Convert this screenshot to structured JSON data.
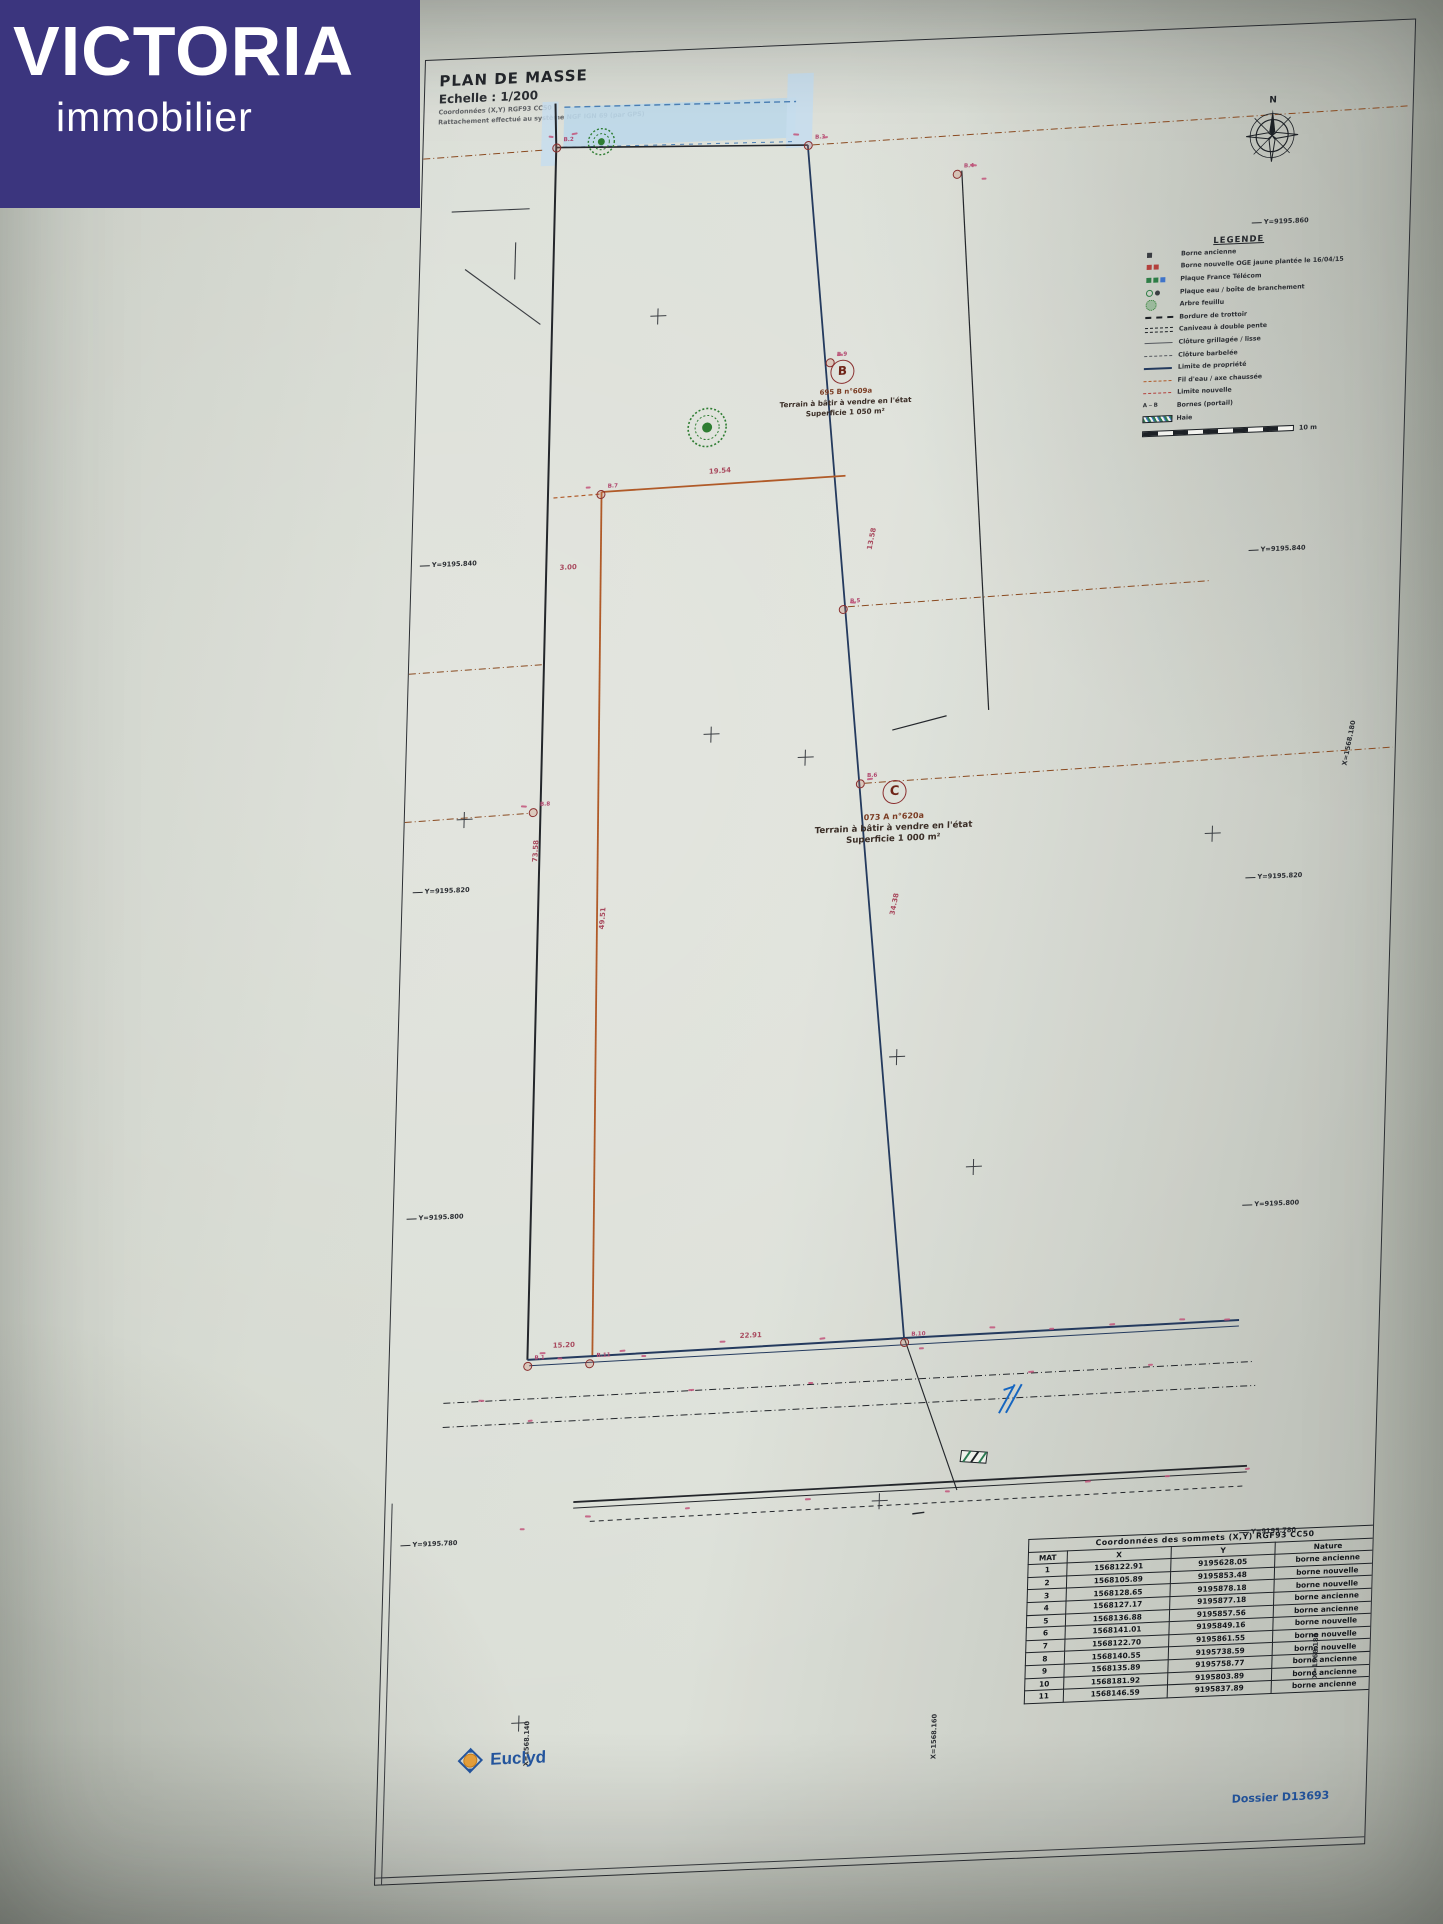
{
  "colors": {
    "brand_bg": "#3b357e",
    "blue_accent": "#2456a0",
    "boundary_navy": "#243a5e",
    "parcel_orange": "#b05a28",
    "annotation_pink": "#c2547a",
    "water_blue": "#bdd8e9"
  },
  "logo": {
    "brand": "VICTORIA",
    "subtitle": "immobilier"
  },
  "title_block": {
    "title": "PLAN DE MASSE",
    "scale": "Echelle : 1/200",
    "note1": "Coordonnées (X,Y) RGF93 CC50",
    "note2": "Rattachement effectué au système NGF IGN 69 (par GPS)"
  },
  "compass": {
    "label": "N"
  },
  "legend": {
    "title": "LEGENDE",
    "scale_label": "10 m",
    "items": [
      {
        "sym": "sqb",
        "label": "Borne ancienne"
      },
      {
        "sym": "sqr",
        "label": "Borne nouvelle OGE jaune plantée le 16/04/15"
      },
      {
        "sym": "sqg",
        "label": "Plaque France Télécom"
      },
      {
        "sym": "cg",
        "label": "Plaque eau / boîte de branchement"
      },
      {
        "sym": "tree",
        "label": "Arbre feuillu"
      },
      {
        "sym": "dashb",
        "label": "Bordure de trottoir"
      },
      {
        "sym": "dash2",
        "label": "Caniveau à double pente"
      },
      {
        "sym": "thin",
        "label": "Clôture grillagée / lisse"
      },
      {
        "sym": "thin2",
        "label": "Clôture barbelée"
      },
      {
        "sym": "blue",
        "label": "Limite de propriété"
      },
      {
        "sym": "orng",
        "label": "Fil d'eau / axe chaussée"
      },
      {
        "sym": "red",
        "label": "Limite nouvelle"
      },
      {
        "sym": "ab",
        "symtext": "A ⎯ B",
        "label": "Bornes (portail)"
      },
      {
        "sym": "hatch",
        "label": "Haie"
      }
    ]
  },
  "parcels": {
    "b": {
      "id": "B",
      "ref": "695 B n°609a",
      "desc": "Terrain à bâtir à vendre en l'état",
      "area": "Superficie 1 050 m²"
    },
    "c": {
      "id": "C",
      "ref": "073 A n°620a",
      "desc": "Terrain à bâtir à vendre en l'état",
      "area": "Superficie 1 000 m²"
    }
  },
  "grid": {
    "left": [
      {
        "text": "Y=9195.840",
        "x": 8,
        "y": 500
      },
      {
        "text": "Y=9195.820",
        "x": 10,
        "y": 826
      },
      {
        "text": "Y=9195.800",
        "x": 13,
        "y": 1152
      },
      {
        "text": "Y=9195.780",
        "x": 16,
        "y": 1478
      }
    ],
    "right": [
      {
        "text": "Y=9195.860",
        "x": 832,
        "y": 192
      },
      {
        "text": "Y=9195.840",
        "x": 838,
        "y": 519
      },
      {
        "text": "Y=9195.820",
        "x": 844,
        "y": 846
      },
      {
        "text": "Y=9195.800",
        "x": 850,
        "y": 1173
      },
      {
        "text": "Y=9195.780",
        "x": 856,
        "y": 1500
      }
    ],
    "bottom": [
      {
        "text": "X=1568.140",
        "x": 152,
        "y": 1700
      },
      {
        "text": "X=1568.160",
        "x": 560,
        "y": 1710
      },
      {
        "text": "X=1568.180",
        "x": 940,
        "y": 1645
      }
    ],
    "right_mid": {
      "text": "X=1568.180",
      "x": 944,
      "y": 735
    }
  },
  "dimensions": [
    {
      "text": "19.54",
      "x": 295,
      "y": 418,
      "r": -2
    },
    {
      "text": "3.00",
      "x": 148,
      "y": 508,
      "r": 0
    },
    {
      "text": "49.51",
      "x": 190,
      "y": 860,
      "r": -87
    },
    {
      "text": "73.58",
      "x": 121,
      "y": 790,
      "r": -88
    },
    {
      "text": "13.58",
      "x": 449,
      "y": 492,
      "r": -80
    },
    {
      "text": "34.38",
      "x": 482,
      "y": 858,
      "r": -80
    },
    {
      "text": "22.91",
      "x": 350,
      "y": 1283,
      "r": 0
    },
    {
      "text": "15.20",
      "x": 163,
      "y": 1285,
      "r": 0
    }
  ],
  "points": [
    {
      "label": "B.1",
      "x": 138,
      "y": 1308
    },
    {
      "label": "B.2",
      "x": 133,
      "y": 92
    },
    {
      "label": "B.3",
      "x": 385,
      "y": 100
    },
    {
      "label": "B.4",
      "x": 535,
      "y": 135
    },
    {
      "label": "B.5",
      "x": 433,
      "y": 565
    },
    {
      "label": "B.6",
      "x": 455,
      "y": 740
    },
    {
      "label": "B.7",
      "x": 187,
      "y": 440
    },
    {
      "label": "B.8",
      "x": 128,
      "y": 755
    },
    {
      "label": "B.9",
      "x": 413,
      "y": 318
    },
    {
      "label": "B.10",
      "x": 515,
      "y": 1300
    },
    {
      "label": "B.11",
      "x": 200,
      "y": 1308
    }
  ],
  "crosses": [
    [
      240,
      265
    ],
    [
      305,
      685
    ],
    [
      60,
      760
    ],
    [
      400,
      712
    ],
    [
      810,
      805
    ],
    [
      500,
      1015
    ],
    [
      580,
      1128
    ],
    [
      495,
      1458
    ],
    [
      140,
      1665
    ]
  ],
  "marks": [
    [
      125,
      80,
      5,
      10
    ],
    [
      148,
      78,
      6,
      -8
    ],
    [
      370,
      88,
      6,
      5
    ],
    [
      400,
      92,
      5,
      -6
    ],
    [
      548,
      126,
      7,
      8
    ],
    [
      560,
      140,
      5,
      0
    ],
    [
      420,
      310,
      6,
      -5
    ],
    [
      440,
      558,
      6,
      6
    ],
    [
      462,
      735,
      6,
      -4
    ],
    [
      116,
      748,
      6,
      5
    ],
    [
      172,
      432,
      5,
      0
    ],
    [
      150,
      1295,
      6,
      0
    ],
    [
      168,
      1301,
      5,
      4
    ],
    [
      230,
      1296,
      6,
      -3
    ],
    [
      252,
      1302,
      5,
      3
    ],
    [
      330,
      1291,
      6,
      0
    ],
    [
      430,
      1292,
      6,
      -4
    ],
    [
      600,
      1288,
      6,
      3
    ],
    [
      660,
      1292,
      5,
      0
    ],
    [
      720,
      1290,
      6,
      -3
    ],
    [
      790,
      1288,
      6,
      3
    ],
    [
      530,
      1306,
      5,
      0
    ],
    [
      90,
      1340,
      6,
      4
    ],
    [
      140,
      1362,
      5,
      -4
    ],
    [
      300,
      1338,
      6,
      0
    ],
    [
      420,
      1336,
      5,
      3
    ],
    [
      640,
      1334,
      6,
      -3
    ],
    [
      760,
      1332,
      5,
      0
    ],
    [
      200,
      1460,
      6,
      3
    ],
    [
      300,
      1456,
      5,
      -3
    ],
    [
      420,
      1452,
      6,
      0
    ],
    [
      560,
      1450,
      5,
      4
    ],
    [
      700,
      1446,
      6,
      -3
    ],
    [
      780,
      1444,
      5,
      0
    ],
    [
      135,
      1470,
      5,
      3
    ],
    [
      835,
      1290,
      6,
      0
    ],
    [
      860,
      1440,
      5,
      -4
    ]
  ],
  "table": {
    "title": "Coordonnées des sommets (X,Y) RGF93 CC50",
    "columns": [
      "MAT",
      "X",
      "Y",
      "Nature"
    ],
    "rows": [
      [
        "1",
        "1568122.91",
        "9195628.05",
        "borne ancienne"
      ],
      [
        "2",
        "1568105.89",
        "9195853.48",
        "borne nouvelle"
      ],
      [
        "3",
        "1568128.65",
        "9195878.18",
        "borne nouvelle"
      ],
      [
        "4",
        "1568127.17",
        "9195877.18",
        "borne ancienne"
      ],
      [
        "5",
        "1568136.88",
        "9195857.56",
        "borne ancienne"
      ],
      [
        "6",
        "1568141.01",
        "9195849.16",
        "borne nouvelle"
      ],
      [
        "7",
        "1568122.70",
        "9195861.55",
        "borne nouvelle"
      ],
      [
        "8",
        "1568140.55",
        "9195738.59",
        "borne nouvelle"
      ],
      [
        "9",
        "1568135.89",
        "9195758.77",
        "borne ancienne"
      ],
      [
        "10",
        "1568181.92",
        "9195803.89",
        "borne ancienne"
      ],
      [
        "11",
        "1568146.59",
        "9195837.89",
        "borne ancienne"
      ]
    ]
  },
  "footer": {
    "firm": "Euclyd",
    "dossier": "Dossier D13693"
  }
}
